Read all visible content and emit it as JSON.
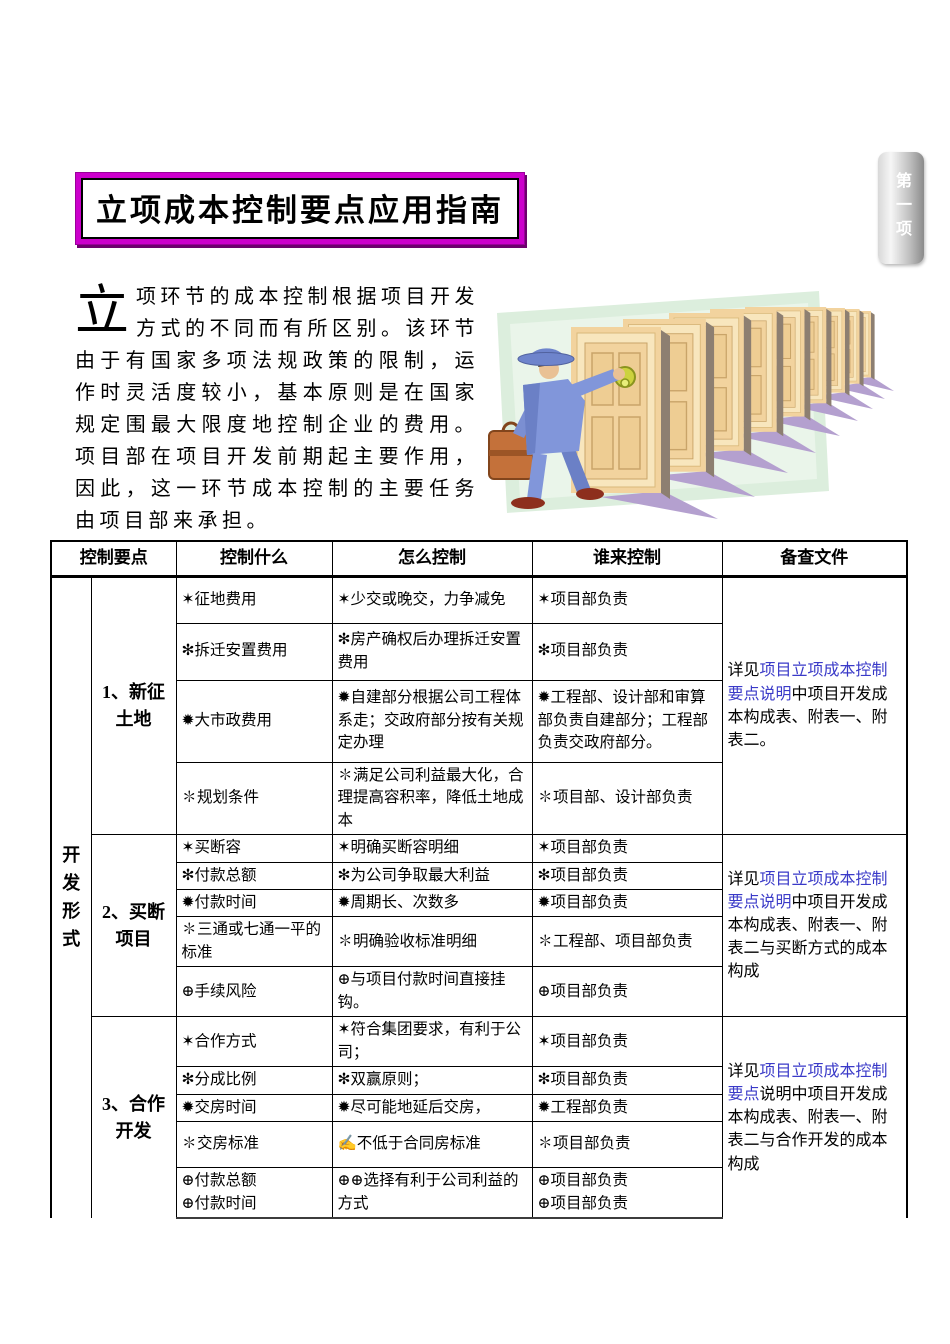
{
  "side_tab": {
    "text": "第一项"
  },
  "title": "立项成本控制要点应用指南",
  "intro": {
    "dropcap": "立",
    "body": "项环节的成本控制根据项目开发方式的不同而有所区别。该环节由于有国家多项法规政策的限制，运作时灵活度较小，基本原则是在国家规定围最大限度地控制企业的费用。项目部在项目开发前期起主要作用，因此，这一环节成本控制的主要任务由项目部来承担。"
  },
  "illustration": {
    "name": "man-knocking-on-row-of-doors-clipart"
  },
  "colors": {
    "title_border_magenta": "#cc00cc",
    "link_blue": "#3a3ac8",
    "tab_gray": "#8b8b8b",
    "clipart_green": "#dceedd",
    "clipart_shadow_purple": "#b4a0cf",
    "door_tan": "#f2d39e"
  },
  "table": {
    "headers": [
      "控制要点",
      "控制什么",
      "怎么控制",
      "谁来控制",
      "备查文件"
    ],
    "group_label": "开发形式",
    "sections": [
      {
        "label": "1、新征土地",
        "rows": [
          {
            "what": "✶征地费用",
            "how": "✶少交或晚交，力争减免",
            "who": "✶项目部负责"
          },
          {
            "what": "✻拆迁安置费用",
            "how": "✻房产确权后办理拆迁安置费用",
            "who": "✻项目部负责"
          },
          {
            "what": "✹大市政费用",
            "how": "✹自建部分根据公司工程体系走；交政府部分按有关规定办理",
            "who": "✹工程部、设计部和审算部负责自建部分；工程部负责交政府部分。"
          },
          {
            "what": "✽规划条件",
            "how": "✽满足公司利益最大化，合理提高容积率，降低土地成本",
            "who": "✽项目部、设计部负责"
          }
        ],
        "reference": {
          "prefix": "详见",
          "link": "项目立项成本控制要点说明",
          "suffix": "中项目开发成本构成表、附表一、附表二。"
        }
      },
      {
        "label": "2、买断项目",
        "rows": [
          {
            "what": "✶买断容",
            "how": "✶明确买断容明细",
            "who": "✶项目部负责"
          },
          {
            "what": "✻付款总额",
            "how": "✻为公司争取最大利益",
            "who": "✻项目部负责"
          },
          {
            "what": "✹付款时间",
            "how": "✹周期长、次数多",
            "who": "✹项目部负责"
          },
          {
            "what": "✽三通或七通一平的标准",
            "how": "✽明确验收标准明细",
            "who": "✽工程部、项目部负责"
          },
          {
            "what": "⊕手续风险",
            "how": "⊕与项目付款时间直接挂钩。",
            "who": "⊕项目部负责"
          }
        ],
        "reference": {
          "prefix": "详见",
          "link": "项目立项成本控制要点说明",
          "suffix": "中项目开发成本构成表、附表一、附表二与买断方式的成本构成"
        }
      },
      {
        "label": "3、合作开发",
        "rows": [
          {
            "what": "✶合作方式",
            "how": "✶符合集团要求，有利于公司；",
            "who": "✶项目部负责"
          },
          {
            "what": "✻分成比例",
            "how": "✻双赢原则；",
            "who": "✻项目部负责"
          },
          {
            "what": "✹交房时间",
            "how": "✹尽可能地延后交房，",
            "who": "✹工程部负责"
          },
          {
            "what": "✽交房标准",
            "how": "✍不低于合同房标准",
            "who": "✽项目部负责"
          },
          {
            "what": "⊕付款总额\n⊕付款时间",
            "how": "⊕⊕选择有利于公司利益的方式",
            "who": "⊕项目部负责\n⊕项目部负责"
          }
        ],
        "reference": {
          "prefix": "详见",
          "link": "项目立项成本控制要点",
          "suffix": "说明中项目开发成本构成表、附表一、附表二与合作开发的成本构成"
        }
      }
    ]
  }
}
